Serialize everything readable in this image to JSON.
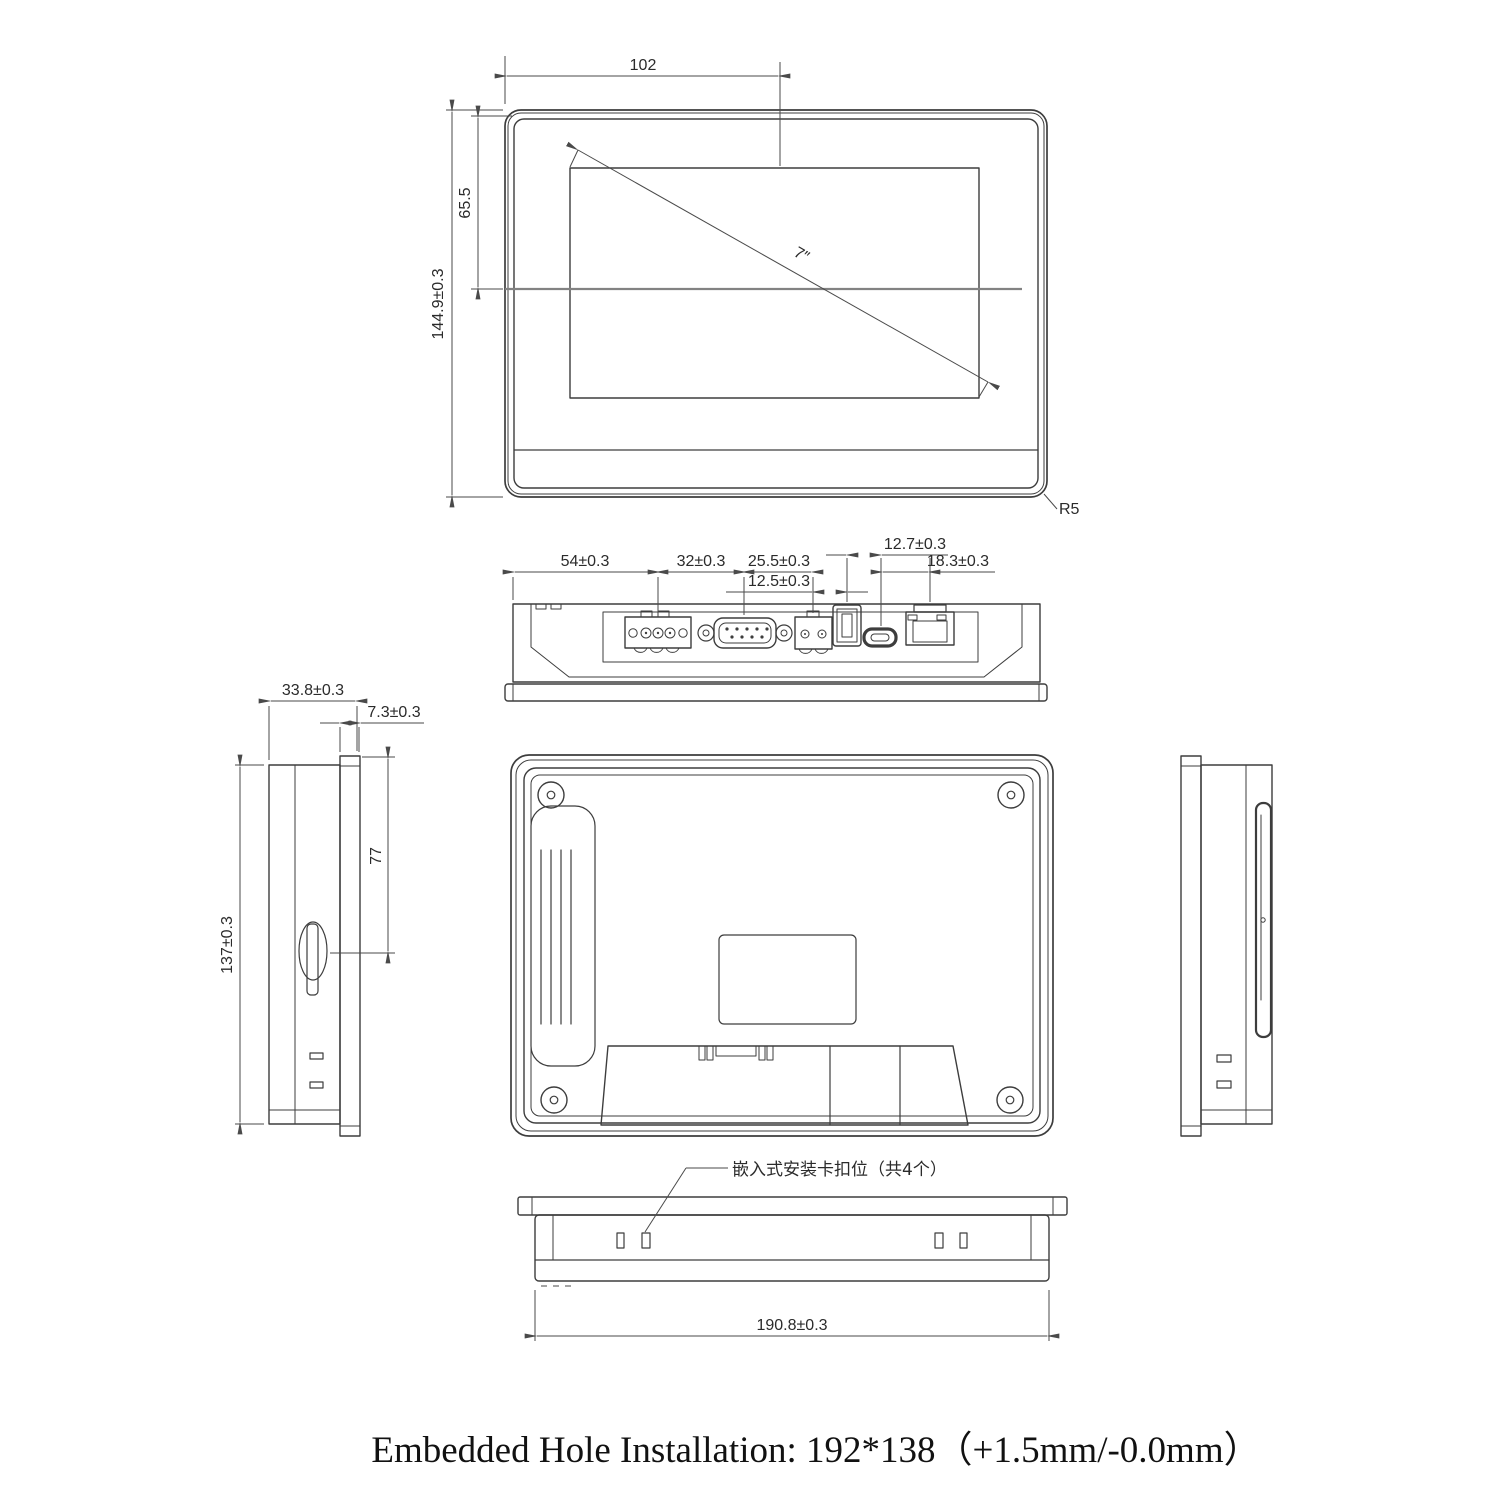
{
  "colors": {
    "line": "#3d3d3d",
    "dimension": "#4a4a4a",
    "centerline": "#828282",
    "background": "#ffffff"
  },
  "front_view": {
    "width_dim": "102",
    "offset_dim": "65.5",
    "height_dim": "144.9±0.3",
    "diagonal_label": "7″",
    "corner_radius_label": "R5"
  },
  "port_view": {
    "usb_offset_dim": "12.7±0.3",
    "power_dim": "54±0.3",
    "serial_dim": "32±0.3",
    "terminal_dim": "25.5±0.3",
    "usb_dim": "12.5±0.3",
    "lan_dim": "18.3±0.3"
  },
  "side_view": {
    "depth_dim": "33.8±0.3",
    "bezel_dim": "7.3±0.3",
    "slot_dim": "77",
    "height_dim": "137±0.3"
  },
  "bottom_view": {
    "width_dim": "190.8±0.3",
    "clip_note": "嵌入式安装卡扣位（共4个）"
  },
  "caption": "Embedded Hole Installation: 192*138（+1.5mm/-0.0mm）"
}
